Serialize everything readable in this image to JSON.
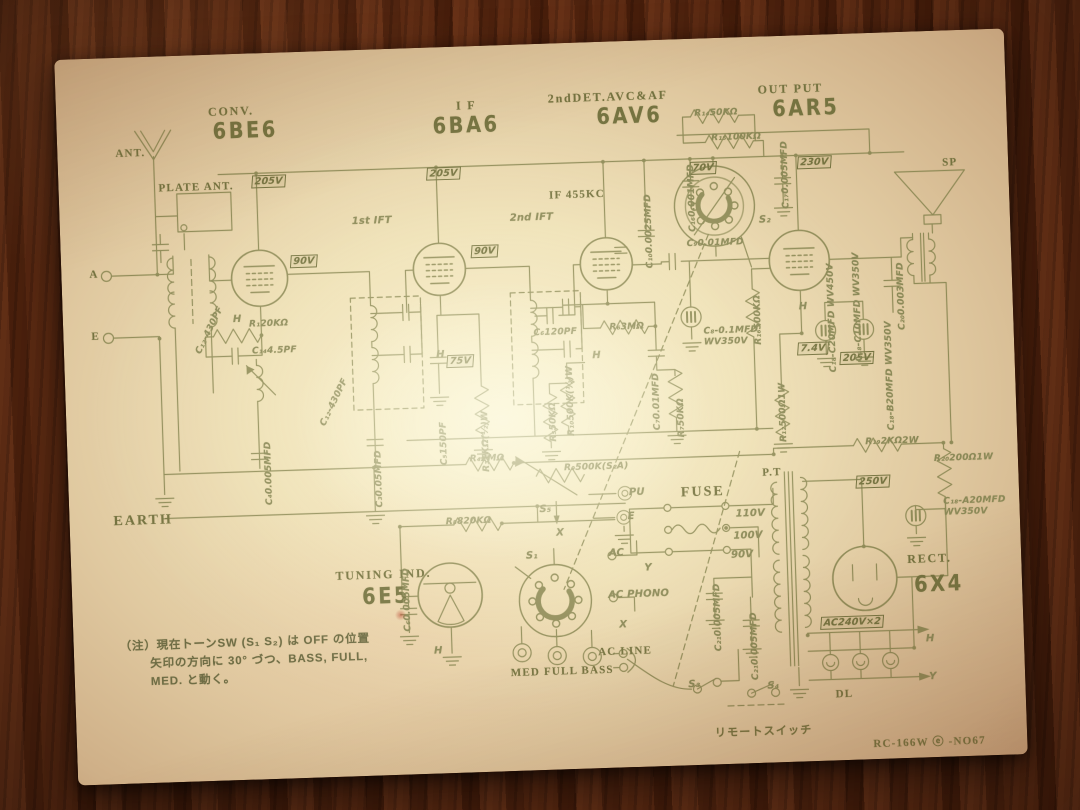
{
  "scene": {
    "description": "Vintage Japanese vacuum-tube radio schematic diagram printed in olive ink on aged tan paper, photographed lying on a dark brown wood-grain table",
    "paper": "aged schematic sheet, slightly tilted",
    "background": "dark wooden table"
  },
  "colors": {
    "ink": "#8b8957",
    "ink_strong": "#757340",
    "paper_center": "#f7efcf",
    "paper_edge": "#c29e78",
    "wood": "#5e2a12"
  },
  "tube_lineup": [
    {
      "function": "CONV.",
      "tube": "6BE6"
    },
    {
      "function": "I F",
      "tube": "6BA6"
    },
    {
      "function": "2ndDET.AVC&AF",
      "tube": "6AV6"
    },
    {
      "function": "OUT PUT",
      "tube": "6AR5"
    },
    {
      "function": "TUNING IND.",
      "tube": "6E5"
    },
    {
      "function": "RECT.",
      "tube": "6X4"
    }
  ],
  "if_frequency": "IF 455KC",
  "power": {
    "fuse": "FUSE",
    "line_taps": [
      "110V",
      "100V",
      "90V"
    ],
    "transformer": "P.T",
    "b_plus": "250V",
    "ht_winding": "AC240V×2"
  },
  "controls": {
    "tone_jacks": "MED FULL BASS",
    "switches": [
      "S₁",
      "S₂",
      "S₃",
      "S₄",
      "S₅"
    ],
    "remote_switch": "リモートスイッチ",
    "dial_lamps": "DL"
  },
  "io": {
    "antenna": "ANT.",
    "plate_antenna": "PLATE ANT.",
    "earth": "EARTH",
    "speaker": "SP",
    "pickup": "PU",
    "ac_line": "AC LINE"
  },
  "model_code": "RC-166W ⓔ -NO67",
  "labels": [
    {
      "t": "CONV.",
      "x": 152,
      "y": 50,
      "cls": "t1",
      "n": "tube-function-conv"
    },
    {
      "t": "6BE6",
      "x": 156,
      "y": 64,
      "cls": "tube",
      "n": "tube-name-6be6"
    },
    {
      "t": "I F",
      "x": 400,
      "y": 52,
      "cls": "t1",
      "n": "tube-function-if"
    },
    {
      "t": "6BA6",
      "x": 376,
      "y": 66,
      "cls": "tube",
      "n": "tube-name-6ba6"
    },
    {
      "t": "2ndDET.AVC&AF",
      "x": 492,
      "y": 48,
      "cls": "t1",
      "n": "tube-function-det"
    },
    {
      "t": "6AV6",
      "x": 540,
      "y": 62,
      "cls": "tube",
      "n": "tube-name-6av6"
    },
    {
      "t": "OUT PUT",
      "x": 702,
      "y": 46,
      "cls": "t1",
      "n": "tube-function-output"
    },
    {
      "t": "6AR5",
      "x": 716,
      "y": 60,
      "cls": "tube",
      "n": "tube-name-6ar5"
    },
    {
      "t": "TUNING IND.",
      "x": 264,
      "y": 518,
      "cls": "t1",
      "n": "tube-function-tuning"
    },
    {
      "t": "6E5",
      "x": 290,
      "y": 534,
      "cls": "tube",
      "n": "tube-name-6e5"
    },
    {
      "t": "RECT.",
      "x": 836,
      "y": 520,
      "cls": "t1",
      "n": "tube-function-rect"
    },
    {
      "t": "6X4",
      "x": 842,
      "y": 540,
      "cls": "tube",
      "n": "tube-name-6x4"
    },
    {
      "t": "ANT.",
      "x": 58,
      "y": 90,
      "cls": "b",
      "n": "antenna-label"
    },
    {
      "t": "PLATE ANT.",
      "x": 100,
      "y": 126,
      "cls": "b",
      "n": "plate-antenna-label"
    },
    {
      "t": "A",
      "x": 28,
      "y": 210,
      "cls": "b"
    },
    {
      "t": "E",
      "x": 28,
      "y": 272,
      "cls": "b"
    },
    {
      "t": "EARTH",
      "x": 44,
      "y": 456,
      "cls": "b2",
      "n": "earth-label"
    },
    {
      "t": "SP",
      "x": 884,
      "y": 126,
      "cls": "b",
      "n": "speaker-label"
    },
    {
      "t": "P.T",
      "x": 694,
      "y": 430,
      "cls": "b",
      "n": "power-transformer-label"
    },
    {
      "t": "FUSE",
      "x": 612,
      "y": 446,
      "cls": "b2",
      "n": "fuse-label"
    },
    {
      "t": "IF 455KC",
      "x": 490,
      "y": 146,
      "cls": "b",
      "n": "if-frequency-label"
    },
    {
      "t": "1st IFT",
      "x": 292,
      "y": 166,
      "cls": "s"
    },
    {
      "t": "2nd IFT",
      "x": 450,
      "y": 168,
      "cls": "s"
    },
    {
      "t": "AC LINE",
      "x": 524,
      "y": 604,
      "cls": "b",
      "n": "ac-line-label"
    },
    {
      "t": "DL",
      "x": 760,
      "y": 654,
      "cls": "b",
      "n": "dial-lamp-label"
    },
    {
      "t": "リモートスイッチ",
      "x": 638,
      "y": 686,
      "cls": "b",
      "n": "remote-switch-label"
    },
    {
      "t": "RC-166W ⓔ -NO67",
      "x": 796,
      "y": 702,
      "cls": "b",
      "n": "model-code"
    },
    {
      "t": "MED FULL BASS",
      "x": 436,
      "y": 622,
      "cls": "b",
      "n": "tone-jack-labels"
    },
    {
      "t": "（注）現在トーンSW (S₁ S₂) は OFF の位置",
      "x": 46,
      "y": 580,
      "cls": "n",
      "n": "note-line"
    },
    {
      "t": "矢印の方向に 30° づつ、BASS, FULL,",
      "x": 76,
      "y": 598,
      "cls": "n",
      "n": "note-line"
    },
    {
      "t": "MED. と動く。",
      "x": 76,
      "y": 616,
      "cls": "n",
      "n": "note-line"
    },
    {
      "t": "205V",
      "x": 194,
      "y": 122,
      "cls": "vb",
      "n": "voltage-box"
    },
    {
      "t": "90V",
      "x": 230,
      "y": 203,
      "cls": "vb",
      "n": "voltage-box"
    },
    {
      "t": "205V",
      "x": 369,
      "y": 120,
      "cls": "vb",
      "n": "voltage-box"
    },
    {
      "t": "90V",
      "x": 411,
      "y": 199,
      "cls": "vb",
      "n": "voltage-box"
    },
    {
      "t": "75V",
      "x": 383,
      "y": 308,
      "cls": "vb",
      "n": "voltage-box"
    },
    {
      "t": "70V",
      "x": 632,
      "y": 123,
      "cls": "vb",
      "n": "voltage-box"
    },
    {
      "t": "230V",
      "x": 740,
      "y": 121,
      "cls": "vb",
      "n": "voltage-box"
    },
    {
      "t": "205V",
      "x": 776,
      "y": 318,
      "cls": "vb",
      "n": "voltage-box"
    },
    {
      "t": "7.4V",
      "x": 734,
      "y": 307,
      "cls": "vb",
      "n": "voltage-box"
    },
    {
      "t": "250V",
      "x": 788,
      "y": 442,
      "cls": "vb",
      "n": "voltage-box"
    },
    {
      "t": "AC240V×2",
      "x": 748,
      "y": 582,
      "cls": "vb",
      "n": "voltage-box"
    },
    {
      "t": "S₁",
      "x": 455,
      "y": 506,
      "cls": "s",
      "n": "switch-s1-label"
    },
    {
      "t": "S₂",
      "x": 699,
      "y": 178,
      "cls": "s",
      "n": "switch-s2-label"
    },
    {
      "t": "S₃",
      "x": 613,
      "y": 640,
      "cls": "s",
      "n": "switch-s3-label"
    },
    {
      "t": "S₄",
      "x": 692,
      "y": 644,
      "cls": "s",
      "n": "switch-s4-label"
    },
    {
      "t": "S₅",
      "x": 470,
      "y": 460,
      "cls": "s",
      "n": "switch-s5-label"
    },
    {
      "t": "PU",
      "x": 560,
      "y": 446,
      "cls": "s",
      "n": "pickup-jack-label"
    },
    {
      "t": "E",
      "x": 558,
      "y": 470,
      "cls": "s"
    },
    {
      "t": "AC",
      "x": 538,
      "y": 506,
      "cls": "s"
    },
    {
      "t": "AC  PHONO",
      "x": 536,
      "y": 548,
      "cls": "s"
    },
    {
      "t": "X",
      "x": 486,
      "y": 484,
      "cls": "s"
    },
    {
      "t": "X",
      "x": 546,
      "y": 578,
      "cls": "s"
    },
    {
      "t": "Y",
      "x": 573,
      "y": 522,
      "cls": "s"
    },
    {
      "t": "H",
      "x": 852,
      "y": 602,
      "cls": "s"
    },
    {
      "t": "Y",
      "x": 854,
      "y": 640,
      "cls": "s"
    },
    {
      "t": "110V",
      "x": 666,
      "y": 471,
      "cls": "s",
      "n": "line-tap-110v"
    },
    {
      "t": "100V",
      "x": 663,
      "y": 493,
      "cls": "s",
      "n": "line-tap-100v"
    },
    {
      "t": "90V",
      "x": 660,
      "y": 512,
      "cls": "s",
      "n": "line-tap-90v"
    },
    {
      "t": "H",
      "x": 170,
      "y": 260,
      "cls": "s"
    },
    {
      "t": "H",
      "x": 372,
      "y": 302,
      "cls": "s"
    },
    {
      "t": "H",
      "x": 528,
      "y": 308,
      "cls": "s"
    },
    {
      "t": "H",
      "x": 736,
      "y": 266,
      "cls": "s"
    },
    {
      "t": "H",
      "x": 360,
      "y": 598,
      "cls": "s"
    },
    {
      "t": "R₁20KΩ",
      "x": 186,
      "y": 266
    },
    {
      "t": "C₁₄4.5PF",
      "x": 188,
      "y": 293
    },
    {
      "t": "C₁₂-430PF",
      "x": 130,
      "y": 296,
      "rot": -62
    },
    {
      "t": "C₁₂-430PF",
      "x": 252,
      "y": 372,
      "rot": -62
    },
    {
      "t": "C₃0.05MFD",
      "x": 306,
      "y": 458,
      "cls": "v"
    },
    {
      "t": "C₄0.005MFD",
      "x": 196,
      "y": 452,
      "cls": "v"
    },
    {
      "t": "C₅150PF",
      "x": 372,
      "y": 418,
      "cls": "v"
    },
    {
      "t": "R₃1KΩ(½)W",
      "x": 414,
      "y": 426,
      "cls": "v"
    },
    {
      "t": "C₆120PF",
      "x": 470,
      "y": 284
    },
    {
      "t": "R₆3MΩ",
      "x": 546,
      "y": 281
    },
    {
      "t": "C₇0.01MFD",
      "x": 586,
      "y": 390,
      "cls": "v"
    },
    {
      "t": "R₇50KΩ",
      "x": 610,
      "y": 398,
      "cls": "v"
    },
    {
      "t": "R₁₀500K(½)W",
      "x": 500,
      "y": 393,
      "cls": "v"
    },
    {
      "t": "R₅50KΩ",
      "x": 482,
      "y": 398,
      "cls": "v"
    },
    {
      "t": "C₉0.01MFD",
      "x": 626,
      "y": 200
    },
    {
      "t": "C₁₀0.0025MFD",
      "x": 584,
      "y": 228,
      "cls": "v"
    },
    {
      "t": "C₁₆0.001MFD",
      "x": 628,
      "y": 193,
      "cls": "v"
    },
    {
      "t": "C₁₇0.005MFD",
      "x": 722,
      "y": 173,
      "cls": "v"
    },
    {
      "t": "R₁₄50KΩ",
      "x": 638,
      "y": 70
    },
    {
      "t": "R₁₅100KΩ",
      "x": 654,
      "y": 95
    },
    {
      "t": "C₈-0.1MFD\nWV350V",
      "x": 640,
      "y": 288
    },
    {
      "t": "R₁₆500KΩ",
      "x": 690,
      "y": 308,
      "cls": "v"
    },
    {
      "t": "R₄2MΩ",
      "x": 402,
      "y": 408
    },
    {
      "t": "R₉500K(S₂A)",
      "x": 496,
      "y": 420
    },
    {
      "t": "R₈820KΩ",
      "x": 376,
      "y": 470
    },
    {
      "t": "C₆0.005MFD",
      "x": 330,
      "y": 583,
      "cls": "v"
    },
    {
      "t": "R₁₂500Ω1W",
      "x": 712,
      "y": 406,
      "cls": "v"
    },
    {
      "t": "C₂₀0.003MFD",
      "x": 834,
      "y": 298,
      "cls": "v"
    },
    {
      "t": "C₁₈-C10MFD WV350V",
      "x": 790,
      "y": 328,
      "cls": "v"
    },
    {
      "t": "C₁₈-C20MFD WV450V",
      "x": 764,
      "y": 338,
      "cls": "v"
    },
    {
      "t": "C₁₈-B20MFD WV350V",
      "x": 820,
      "y": 398,
      "cls": "v"
    },
    {
      "t": "R₁₉2KΩ2W",
      "x": 798,
      "y": 404
    },
    {
      "t": "R₂₀200Ω1W",
      "x": 866,
      "y": 423
    },
    {
      "t": "C₁₈-A20MFD\nWV350V",
      "x": 874,
      "y": 466
    },
    {
      "t": "C₂₁0.005MFD",
      "x": 640,
      "y": 613,
      "cls": "v"
    },
    {
      "t": "C₂₁0.005MFD",
      "x": 676,
      "y": 643,
      "cls": "v"
    }
  ]
}
